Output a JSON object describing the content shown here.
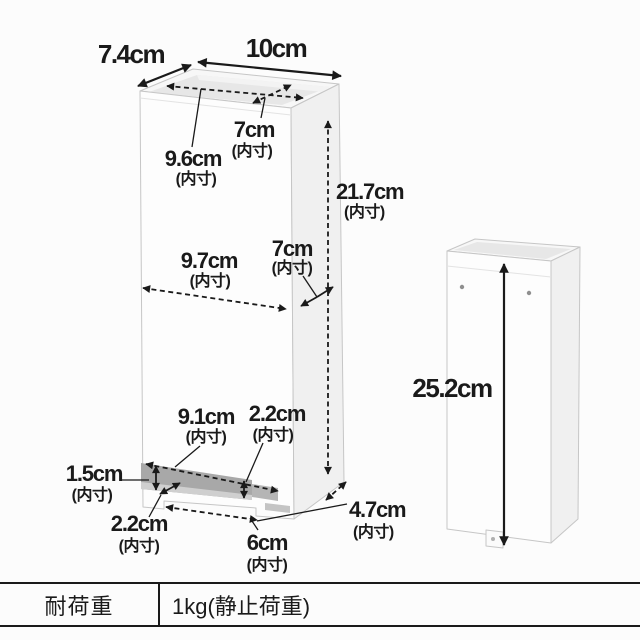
{
  "colors": {
    "background": "#fcfcfc",
    "line_and_text": "#1a1a1a",
    "box_edge": "#c6c6c6",
    "slot_shadow": "#a8a8a8"
  },
  "diagram": {
    "inner_suffix": "(内寸)",
    "front_view": {
      "outer_depth": "7.4cm",
      "outer_width": "10cm",
      "inner_width_top": "9.6cm",
      "inner_depth_top": "7cm",
      "inner_height": "21.7cm",
      "inner_width_middle": "9.7cm",
      "inner_depth_middle": "7cm",
      "slot_width": "9.1cm",
      "slot_height": "1.5cm",
      "slot_corner_depth": "2.2cm",
      "bottom_rail_height": "2.2cm",
      "notch_width": "6cm",
      "inner_depth_bottom": "4.7cm"
    },
    "side_view": {
      "outer_height": "25.2cm"
    }
  },
  "spec_table": {
    "label": "耐荷重",
    "value": "1kg(静止荷重)"
  }
}
